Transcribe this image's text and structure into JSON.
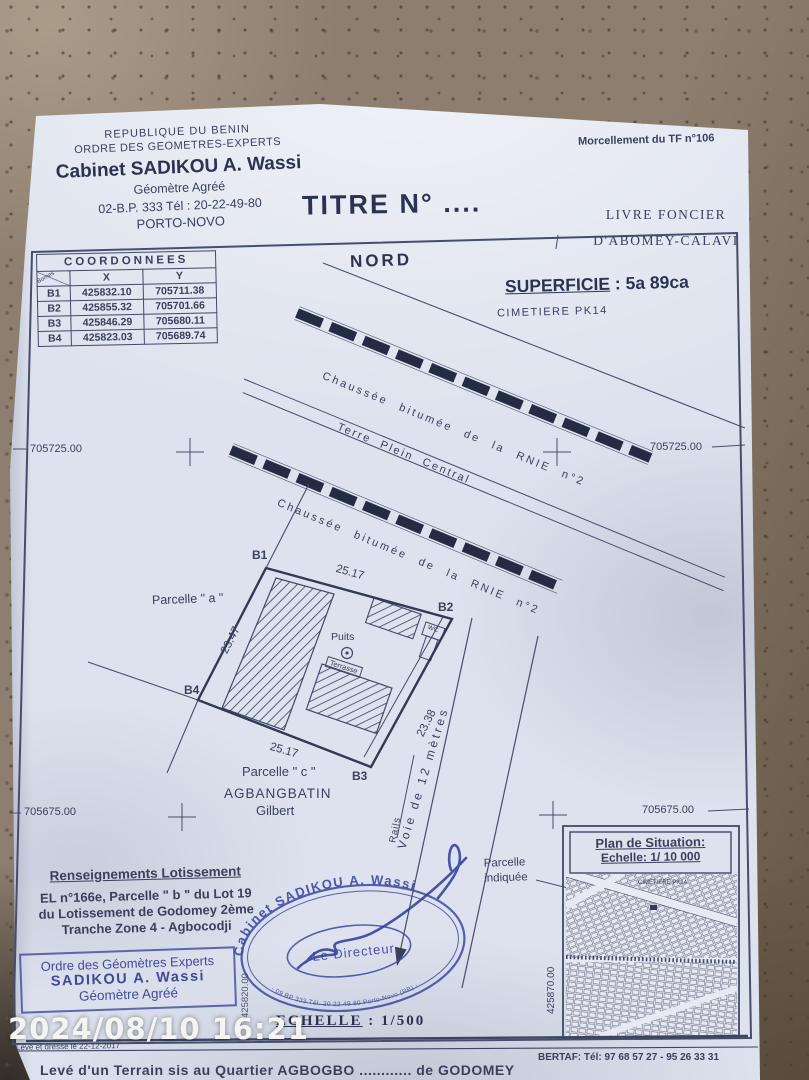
{
  "photo": {
    "timestamp": "2024/08/10 16:21"
  },
  "letterhead": {
    "line1": "REPUBLIQUE DU BENIN",
    "line2": "ORDRE DES GEOMETRES-EXPERTS",
    "cabinet": "Cabinet SADIKOU A. Wassi",
    "subtitle": "Géomètre Agréé",
    "address": "02-B.P. 333 Tél : 20-22-49-80",
    "city": "PORTO-NOVO"
  },
  "doc_title": "TITRE N° ....",
  "top_right": {
    "morcellement": "Morcellement du TF n°106",
    "livre_line1": "LIVRE FONCIER",
    "livre_line2": "D'ABOMEY-CALAVI"
  },
  "coords": {
    "title": "COORDONNEES",
    "corner": "Bornes",
    "col_x": "X",
    "col_y": "Y",
    "rows": [
      {
        "id": "B1",
        "x": "425832.10",
        "y": "705711.38"
      },
      {
        "id": "B2",
        "x": "425855.32",
        "y": "705701.66"
      },
      {
        "id": "B3",
        "x": "425846.29",
        "y": "705680.11"
      },
      {
        "id": "B4",
        "x": "425823.03",
        "y": "705689.74"
      }
    ]
  },
  "plan": {
    "north": "NORD",
    "superficie_label": "SUPERFICIE",
    "superficie_value": ": 5a 89ca",
    "cimetiere": "CIMETIERE PK14",
    "road_top": "Chaussée bitumée de la   RNIE n°2",
    "terre_plein": "Terre Plein Central",
    "road_bottom": "Chaussée bitumée de la   RNIE n°2",
    "grid": {
      "nw": "705725.00",
      "ne": "705725.00",
      "sw": "705675.00",
      "se": "705675.00",
      "v_left": "425820.00",
      "v_right": "425870.00"
    },
    "parcel": {
      "b1": "B1",
      "b2": "B2",
      "b3": "B3",
      "b4": "B4",
      "dim_top": "25.17",
      "dim_right": "23.38",
      "dim_bottom": "25.17",
      "dim_left": "23.47",
      "parcelle_a": "Parcelle \" a \"",
      "parcelle_c": "Parcelle \" c \"",
      "owner_line1": "AGBANGBATIN",
      "owner_line2": "Gilbert",
      "puits": "Puits",
      "terrasse": "Terrasse",
      "wc": "WC"
    },
    "voie": "Voie de 12 mètres",
    "rails": "Rails"
  },
  "renseignements": {
    "title": "Renseignements Lotissement",
    "line1": "EL n°166e,  Parcelle \" b \" du Lot 19",
    "line2": "du Lotissement de Godomey 2ème",
    "line3": "Tranche Zone 4 - Agbocodji"
  },
  "stamp_rect": {
    "line1": "Ordre des Géomètres Experts",
    "line2": "SADIKOU A. Wassi",
    "line3": "Géomètre Agréé"
  },
  "stamp_oval": {
    "top": "Cabinet SADIKOU A. Wassi",
    "center": "Le Directeur",
    "bottom": "- 09 BP 333 Tél. 20 22 49 80  Porto-Novo (RB) -"
  },
  "echelle": {
    "label": "ECHELLE",
    "value": ": 1/500"
  },
  "situation": {
    "title": "Plan de Situation:",
    "scale": "Echelle: 1/ 10 000",
    "cimetiere": "CIMETIERE PK14",
    "pointer_line1": "Parcelle",
    "pointer_line2": "indiquée"
  },
  "notes": {
    "drafted": "Levé et dressé le 22-12-2017",
    "bottom": "Levé d'un Terrain sis au Quartier AGBOGBO ............ de GODOMEY"
  },
  "footer": {
    "bertaf": "BERTAF: Tél: 97 68 57 27 - 95 26 33 31"
  },
  "colors": {
    "ink": "#39415c",
    "stamp": "#3d47a0",
    "paper": "#dde2ee"
  }
}
